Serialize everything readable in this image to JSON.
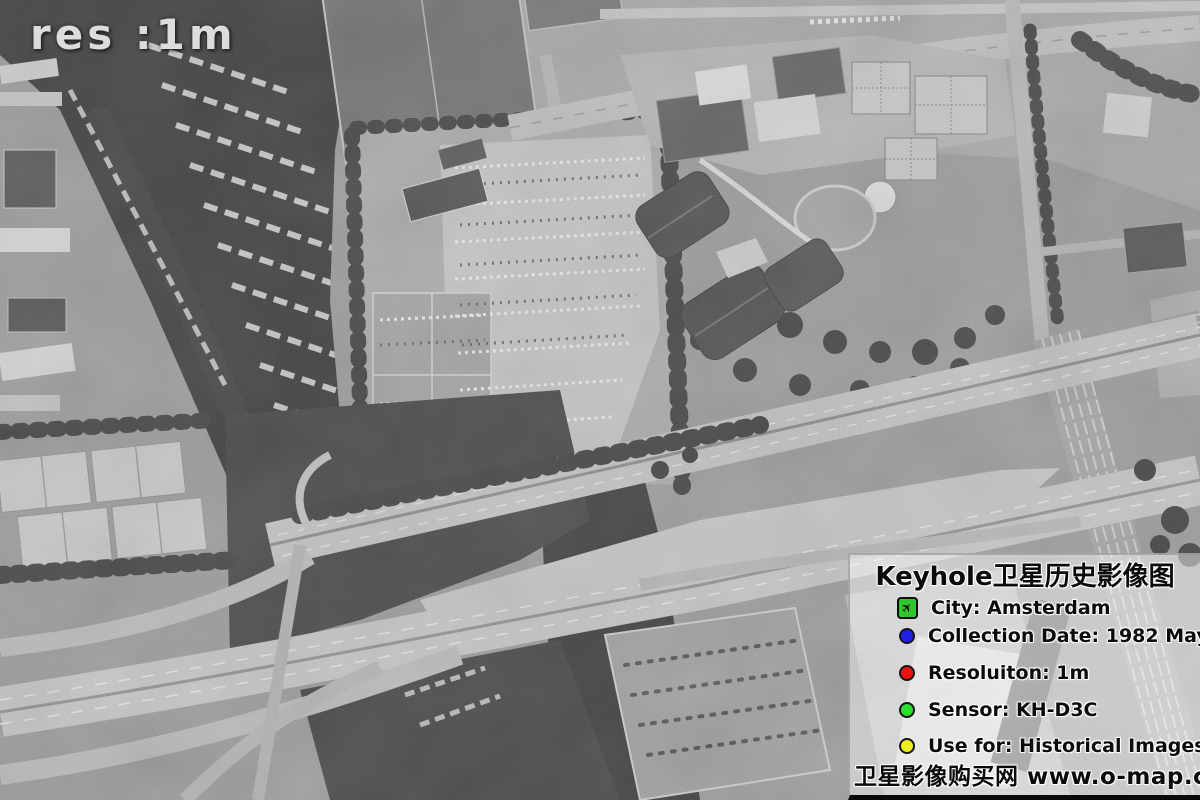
{
  "overlay": {
    "resolution_label": "res :1m"
  },
  "panel": {
    "title": "Keyhole卫星历史影像图",
    "items": [
      {
        "icon": "airport-icon",
        "color": "#2dc62d",
        "label": "City: Amsterdam"
      },
      {
        "icon": "blue-dot-icon",
        "color": "#1f1fe8",
        "label": "Collection Date: 1982 May"
      },
      {
        "icon": "red-dot-icon",
        "color": "#e81414",
        "label": "Resoluiton: 1m"
      },
      {
        "icon": "green-dot-icon",
        "color": "#2ae02a",
        "label": "Sensor: KH-D3C"
      },
      {
        "icon": "yellow-dot-icon",
        "color": "#f0ec1f",
        "label": "Use for: Historical Images"
      }
    ],
    "footer": "卫星影像购买网 www.o-map.cn"
  },
  "image": {
    "type": "black-and-white satellite photograph",
    "scene": "Amsterdam highway interchange, canal with houseboats, sports fields, parking lots, exhibition halls, park and railway yard"
  }
}
